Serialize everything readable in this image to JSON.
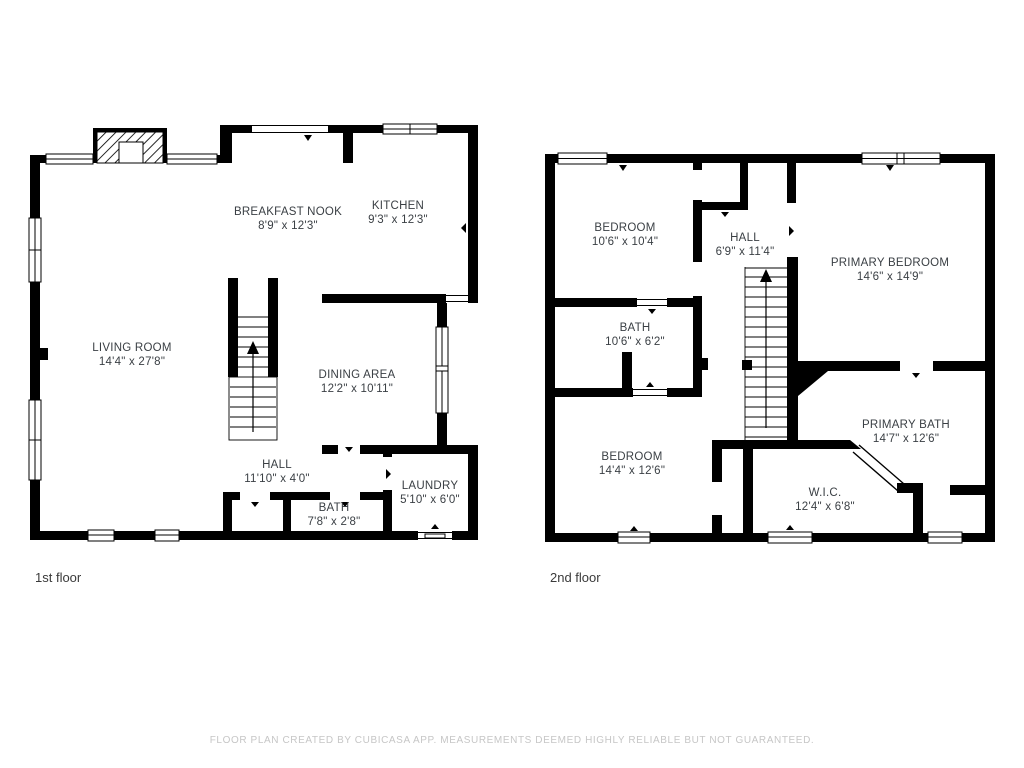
{
  "title": "Floor plan",
  "floors": [
    {
      "label": "1st floor",
      "rooms": [
        {
          "name": "BREAKFAST NOOK",
          "dims": "8'9\" x 12'3\""
        },
        {
          "name": "KITCHEN",
          "dims": "9'3\" x 12'3\""
        },
        {
          "name": "LIVING ROOM",
          "dims": "14'4\" x 27'8\""
        },
        {
          "name": "DINING AREA",
          "dims": "12'2\" x 10'11\""
        },
        {
          "name": "HALL",
          "dims": "11'10\" x 4'0\""
        },
        {
          "name": "BATH",
          "dims": "7'8\" x 2'8\""
        },
        {
          "name": "LAUNDRY",
          "dims": "5'10\" x 6'0\""
        }
      ]
    },
    {
      "label": "2nd floor",
      "rooms": [
        {
          "name": "BEDROOM",
          "dims": "10'6\" x 10'4\""
        },
        {
          "name": "HALL",
          "dims": "6'9\" x 11'4\""
        },
        {
          "name": "PRIMARY BEDROOM",
          "dims": "14'6\" x 14'9\""
        },
        {
          "name": "BATH",
          "dims": "10'6\" x 6'2\""
        },
        {
          "name": "BEDROOM",
          "dims": "14'4\" x 12'6\""
        },
        {
          "name": "PRIMARY BATH",
          "dims": "14'7\" x 12'6\""
        },
        {
          "name": "W.I.C.",
          "dims": "12'4\" x 6'8\""
        }
      ]
    }
  ],
  "footer": "FLOOR PLAN CREATED BY CUBICASA APP. MEASUREMENTS DEEMED HIGHLY RELIABLE BUT NOT GUARANTEED.",
  "colors": {
    "wall": "#000000",
    "label": "#3a3f44",
    "footer": "#c6c6c6",
    "background": "#ffffff"
  }
}
